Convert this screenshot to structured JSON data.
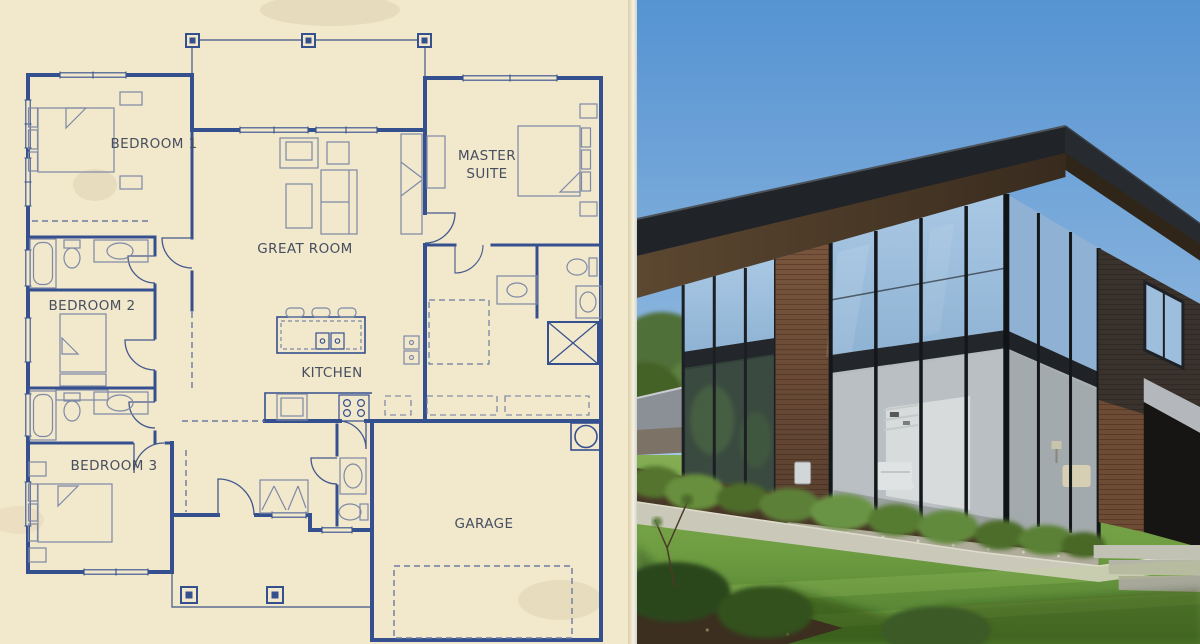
{
  "scene": {
    "left_panel": "architectural blueprint floor plan on aged cream paper",
    "right_panel": "photograph of the finished modern two-story house exterior"
  },
  "floor_plan": {
    "style": "blueprint",
    "colors": {
      "paper": "#f2e8cc",
      "wall_line": "#35508f",
      "furniture_line": "#7e89a6",
      "label_text": "#464e60"
    },
    "rooms": [
      {
        "id": "bedroom-1",
        "label": "BEDROOM 1"
      },
      {
        "id": "great-room",
        "label": "GREAT ROOM"
      },
      {
        "id": "master-suite",
        "label": "MASTER SUITE",
        "line1": "MASTER",
        "line2": "SUITE"
      },
      {
        "id": "bedroom-2",
        "label": "BEDROOM 2"
      },
      {
        "id": "kitchen",
        "label": "KITCHEN"
      },
      {
        "id": "bedroom-3",
        "label": "BEDROOM 3"
      },
      {
        "id": "garage",
        "label": "GARAGE"
      }
    ],
    "features": [
      "covered porch with three posts at top",
      "front porch with two posts at bottom",
      "kitchen island with three stools and double sink",
      "four-burner range and refrigerator",
      "wall ovens",
      "four beds with headboards and folded-sheet detail",
      "two hall bathrooms with tub, toilet and vanity",
      "powder room",
      "master bath with X-marked shower, toilet and vanities",
      "dashed walk-in closet",
      "water heater circle in garage corner",
      "dashed garage door opening",
      "window symbols in exterior walls",
      "door swing arcs"
    ]
  },
  "photo": {
    "colors": {
      "sky_top": "#5593d2",
      "sky_bottom": "#a9c9e7",
      "roof": "#1f2225",
      "soffit": "#4a3826",
      "wood_siding": "#6e4b33",
      "wood_dark_band": "#3a322c",
      "glass_sky_reflection": "#a3c4e2",
      "glass_interior": "#b9bfc2",
      "window_frame": "#23262a",
      "lawn": "#6f9d42",
      "lawn_shadow": "#3c6323",
      "walkway": "#cac9b9",
      "mulch": "#473726",
      "shrub": "#5d8038"
    },
    "elements": [
      "flat dark roof with deep overhang",
      "two-story corner glass curtain wall",
      "horizontal wood siding columns",
      "white sofa and shelving visible through glass",
      "shrub planting bed with gravel strip along foundation",
      "concrete walkway",
      "front lawn with tree shadows",
      "entry steps and dark recessed entry at right",
      "neighboring house roof and trees at left",
      "small utility box on wood column"
    ]
  }
}
